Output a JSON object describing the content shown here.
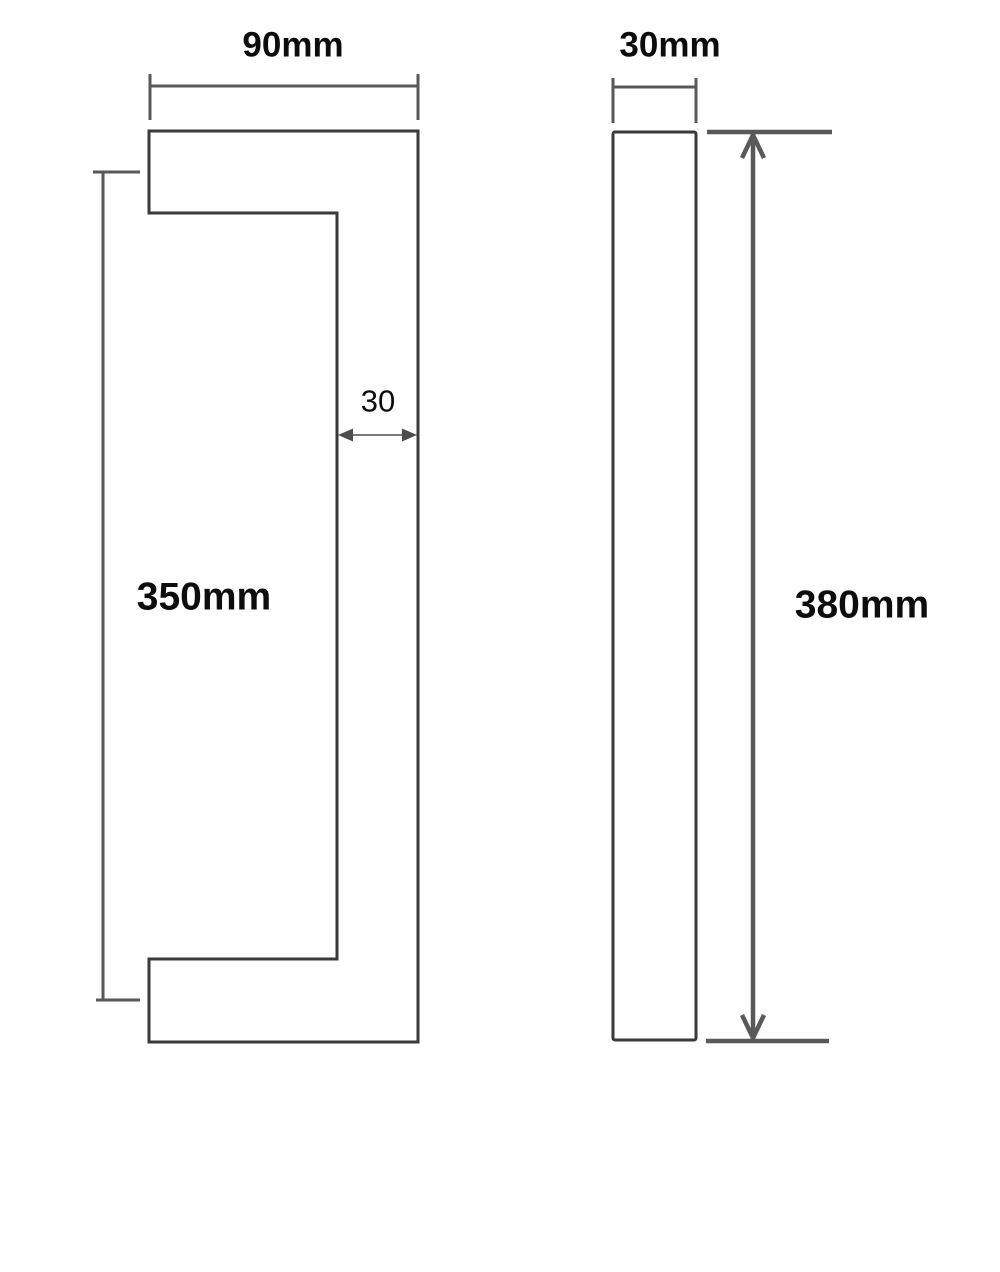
{
  "drawing": {
    "kind": "technical-dimension-drawing",
    "front_view": {
      "width_label": "90mm",
      "height_label": "350mm",
      "bar_thickness_label": "30"
    },
    "side_view": {
      "width_label": "30mm",
      "height_label": "380mm"
    }
  },
  "colors": {
    "outline": "#3a3a3a",
    "dimension": "#595959",
    "arrow_dark": "#4d4d4d",
    "text": "#0d0d0d",
    "background": "#ffffff"
  }
}
